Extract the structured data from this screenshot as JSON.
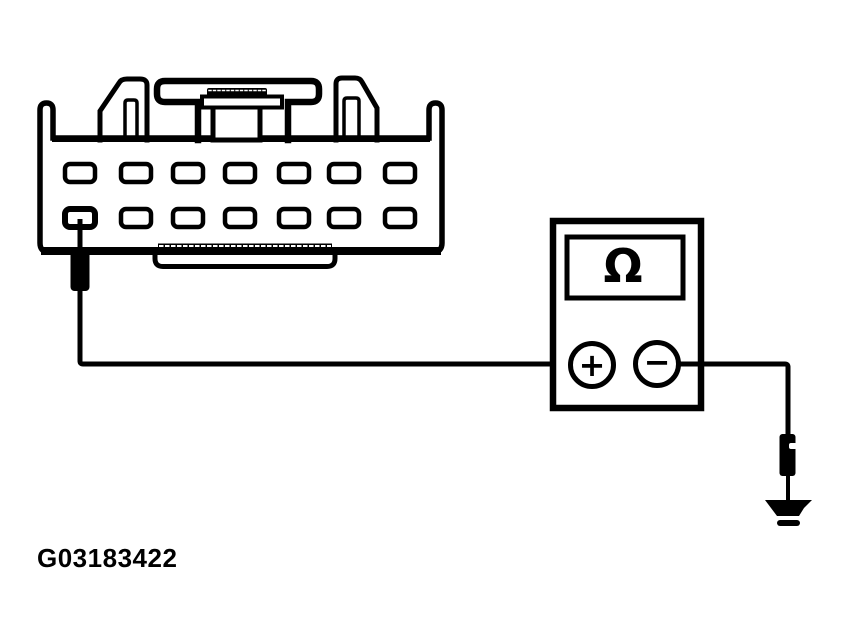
{
  "background_color": "#ffffff",
  "line_color": "#000000",
  "figure": {
    "code": "G03183422"
  },
  "connector": {
    "pin_rows": 2,
    "pins_per_row": 7,
    "total_pins": 14
  },
  "multimeter": {
    "display_symbol": "Ω",
    "positive_terminal_label": "+",
    "negative_terminal_label": "−"
  }
}
